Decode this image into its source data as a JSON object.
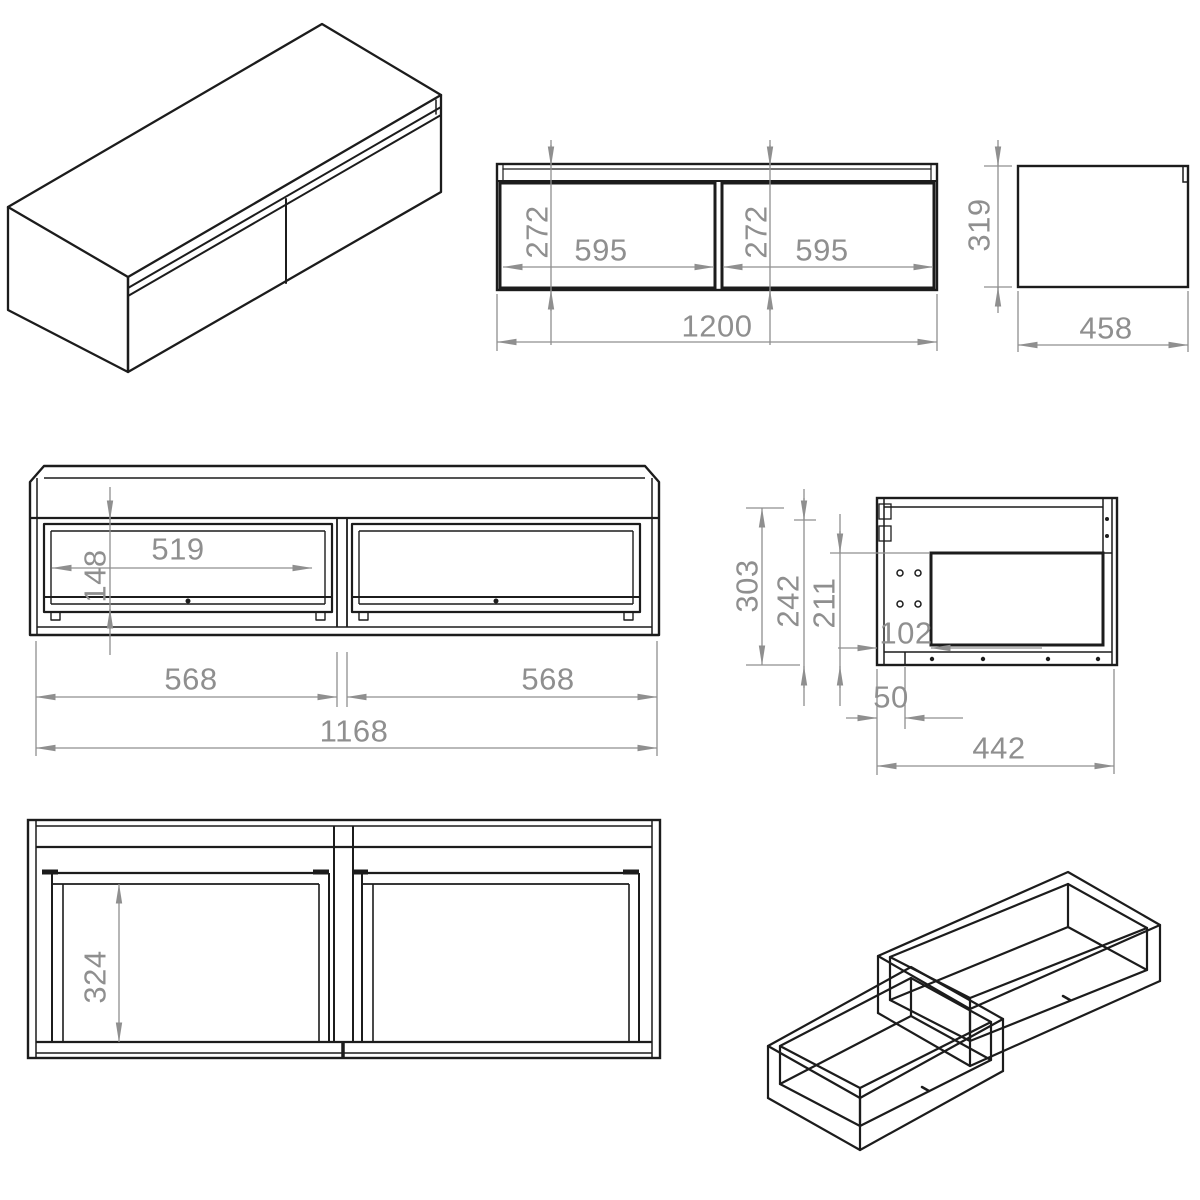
{
  "colors": {
    "object_line": "#1c1c1c",
    "dimension_line": "#8f8f8f",
    "background": "#ffffff"
  },
  "front_view": {
    "drawer_heights": [
      "272",
      "272"
    ],
    "drawer_widths": [
      "595",
      "595"
    ],
    "overall_width": "1200"
  },
  "side_view": {
    "height": "319",
    "depth": "458"
  },
  "carcass_view": {
    "opening_width": "519",
    "opening_height": "148",
    "bay_widths": [
      "568",
      "568"
    ],
    "inner_width": "1168"
  },
  "section_view": {
    "height": "303",
    "back_height": "242",
    "pocket_height": "211",
    "front_offset": "102",
    "bottom_inset": "50",
    "depth": "442"
  },
  "plan_view": {
    "drawer_inner_depth": "324"
  }
}
